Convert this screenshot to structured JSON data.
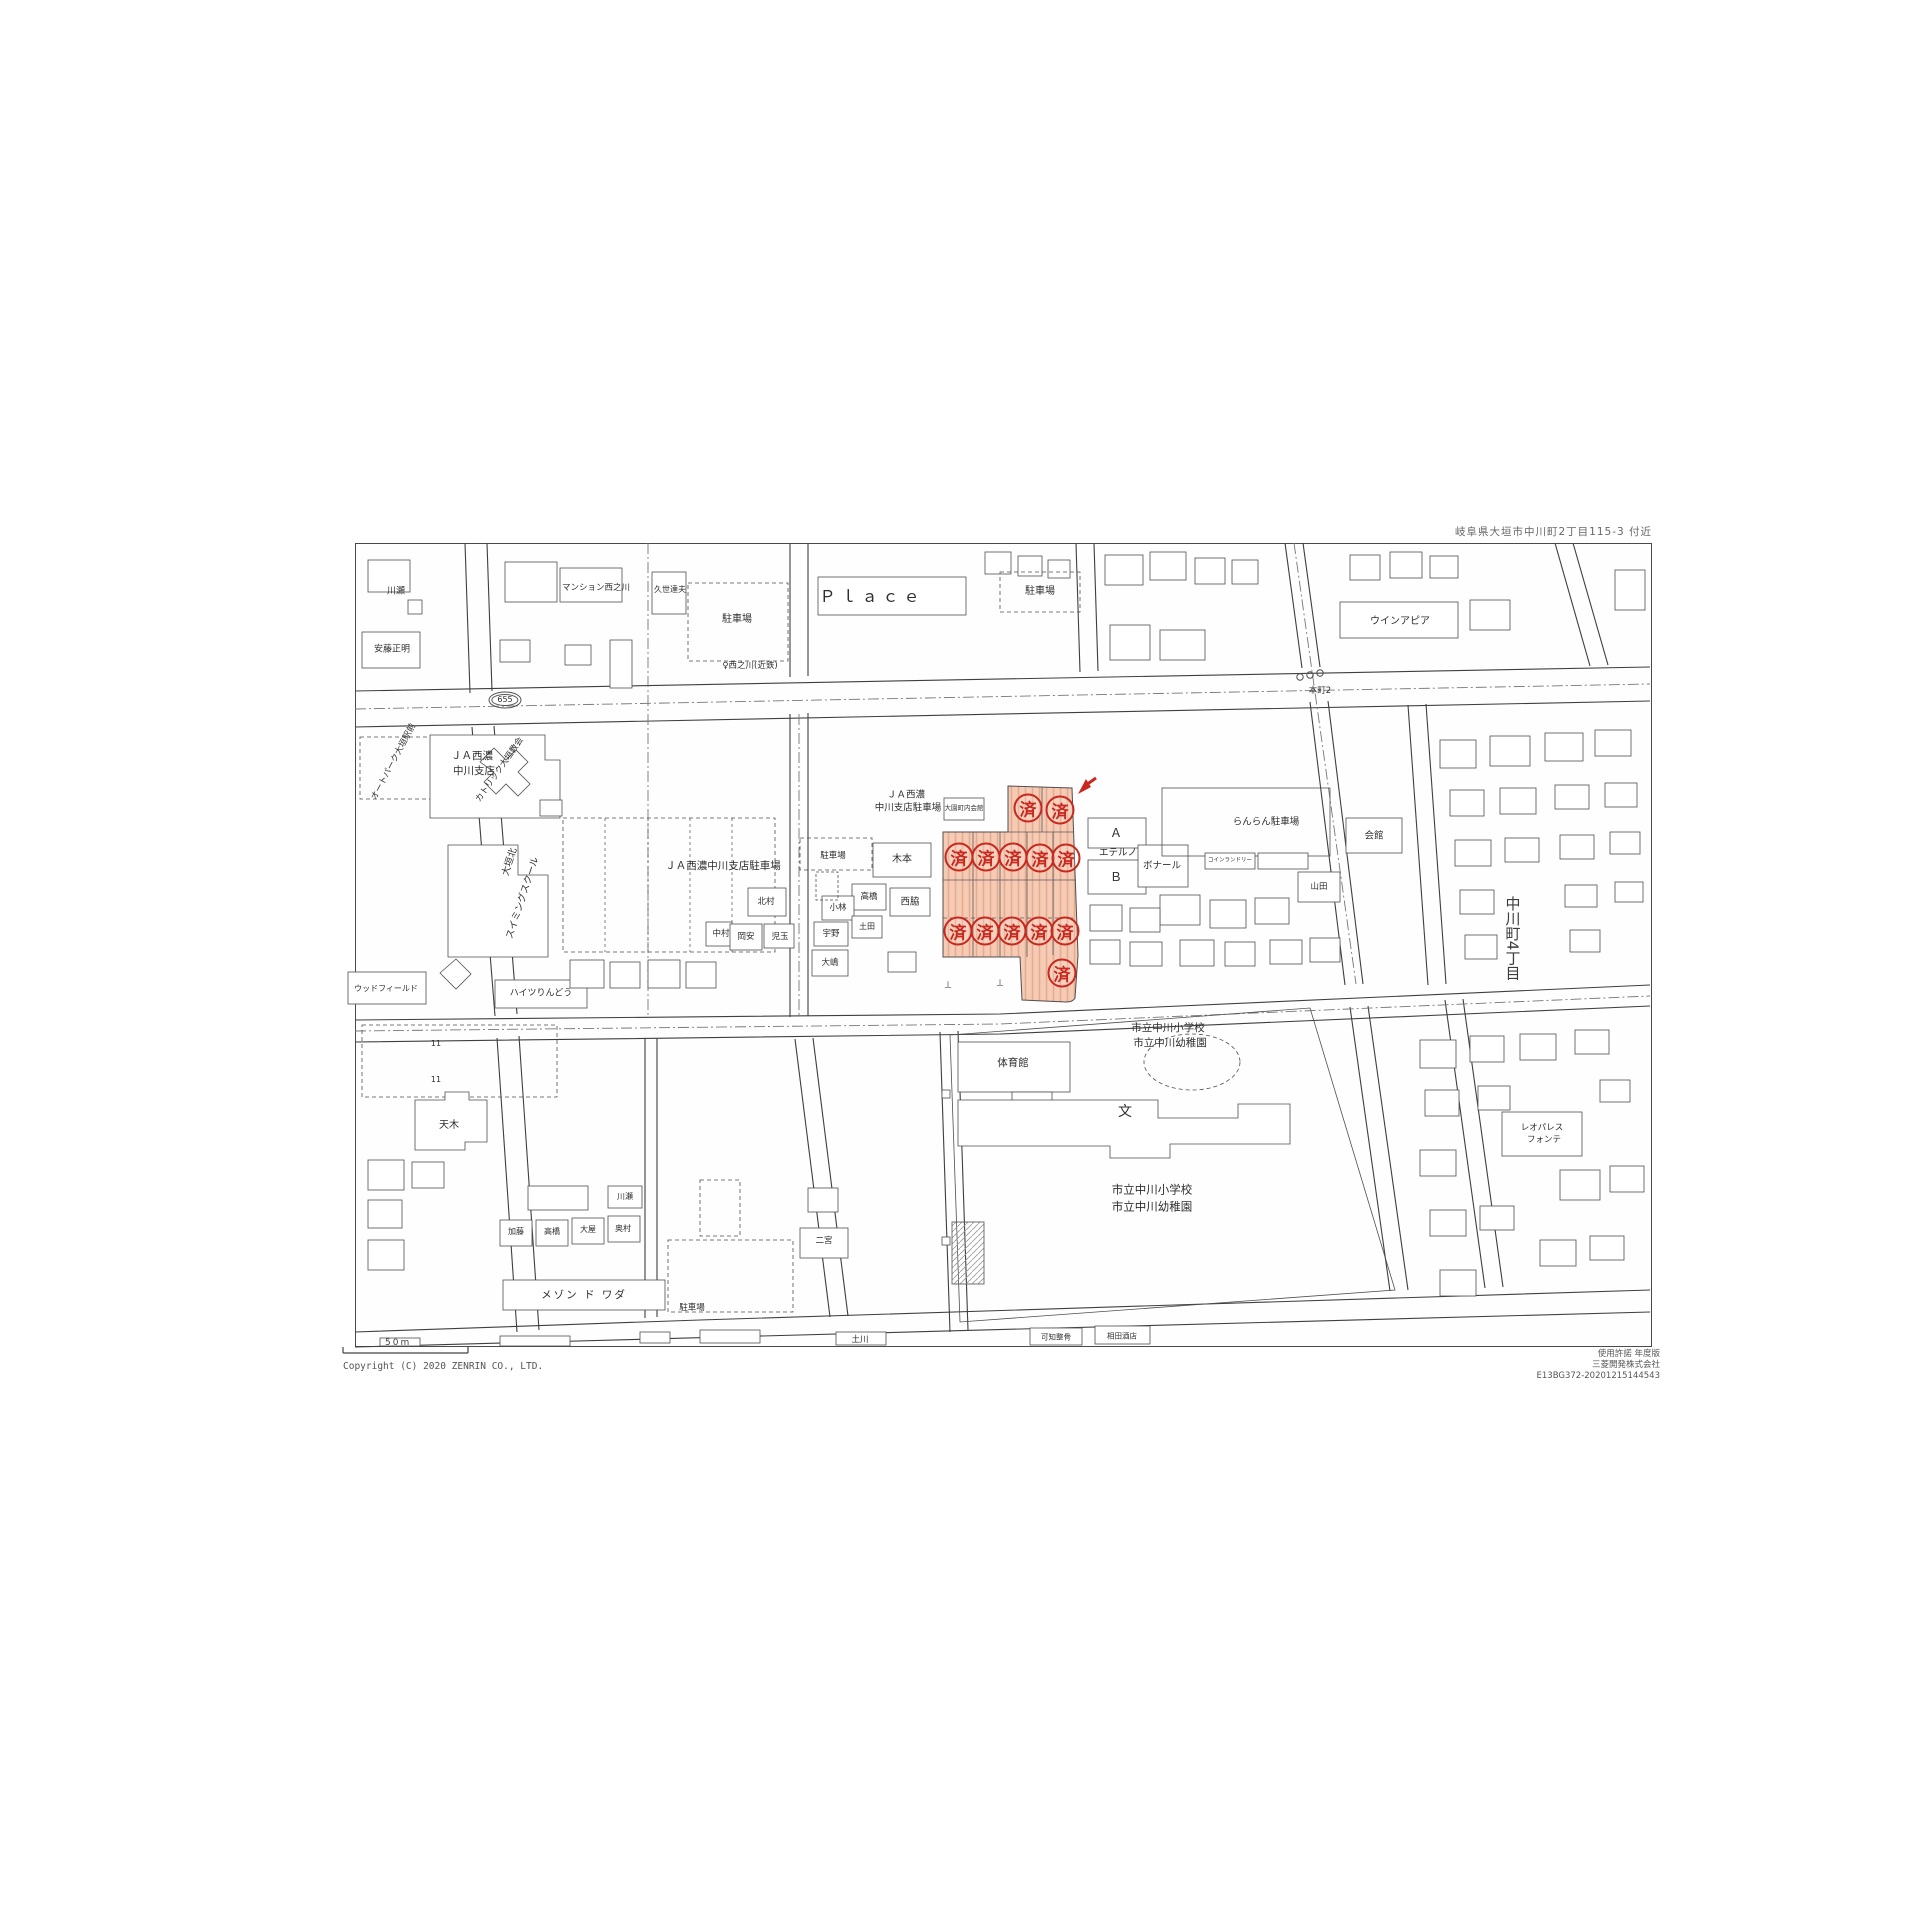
{
  "header": {
    "area_title": "岐阜県大垣市中川町2丁目115-3 付近"
  },
  "footer": {
    "copyright": "Copyright (C) 2020 ZENRIN CO., LTD.",
    "scale_label": "50m",
    "right_lines": [
      "使用許諾 年度版",
      "三菱開発株式会社",
      "E13BG372-20201215144543"
    ]
  },
  "highlight": {
    "stamp_char": "済",
    "stamp_count": 13,
    "stamp_color": "#c8281e",
    "zone_fill": "#f5c6ae",
    "zone_hatch": "#e3a183",
    "stamps": [
      [
        1028,
        808
      ],
      [
        1060,
        810
      ],
      [
        959,
        857
      ],
      [
        986,
        857
      ],
      [
        1013,
        857
      ],
      [
        1040,
        858
      ],
      [
        1066,
        858
      ],
      [
        958,
        931
      ],
      [
        985,
        931
      ],
      [
        1012,
        931
      ],
      [
        1039,
        931
      ],
      [
        1065,
        931
      ],
      [
        1062,
        973
      ]
    ]
  },
  "map": {
    "labels": [
      {
        "t": "Ｐｌａｃｅ",
        "x": 872,
        "y": 597,
        "s": 16,
        "ls": 5,
        "n": "label-place"
      },
      {
        "t": "駐車場",
        "x": 737,
        "y": 620,
        "s": 10
      },
      {
        "t": "駐車場",
        "x": 1040,
        "y": 592,
        "s": 10
      },
      {
        "t": "マンション西之川",
        "x": 596,
        "y": 588,
        "s": 8.5
      },
      {
        "t": "川瀬",
        "x": 396,
        "y": 592,
        "s": 9
      },
      {
        "t": "安藤正明",
        "x": 392,
        "y": 650,
        "s": 9
      },
      {
        "t": "久世達夫",
        "x": 670,
        "y": 590,
        "s": 8
      },
      {
        "t": "ウインアピア",
        "x": 1400,
        "y": 622,
        "s": 10
      },
      {
        "t": "♀西之川(近鉄)",
        "x": 750,
        "y": 666,
        "s": 8.5,
        "n": "bus-stop-label"
      },
      {
        "t": "655",
        "x": 505,
        "y": 700,
        "s": 8,
        "o": true,
        "n": "route-marker"
      },
      {
        "t": "本町2",
        "x": 1320,
        "y": 691,
        "s": 8.5,
        "n": "intersection-label"
      },
      {
        "t": "オートパーク大垣駅前",
        "x": 394,
        "y": 762,
        "s": 8.5,
        "r": -62
      },
      {
        "t": "ＪＡ西濃",
        "x": 472,
        "y": 756,
        "s": 10.5
      },
      {
        "t": "中川支店",
        "x": 474,
        "y": 771,
        "s": 10.5
      },
      {
        "t": "カトリック大垣教会",
        "x": 500,
        "y": 770,
        "s": 8.5,
        "r": -55
      },
      {
        "t": "大垣北",
        "x": 510,
        "y": 862,
        "s": 9.5,
        "r": -72
      },
      {
        "t": "スイミングスクール",
        "x": 523,
        "y": 898,
        "s": 9.5,
        "r": -72
      },
      {
        "t": "ＪＡ西濃中川支店駐車場",
        "x": 723,
        "y": 866,
        "s": 10.5
      },
      {
        "t": "ＪＡ西濃",
        "x": 906,
        "y": 795,
        "s": 9.5
      },
      {
        "t": "中川支店駐車場",
        "x": 908,
        "y": 808,
        "s": 9.5
      },
      {
        "t": "駐車場",
        "x": 833,
        "y": 856,
        "s": 8.5
      },
      {
        "t": "木本",
        "x": 902,
        "y": 860,
        "s": 10
      },
      {
        "t": "北村",
        "x": 766,
        "y": 902,
        "s": 8.5
      },
      {
        "t": "高橋",
        "x": 869,
        "y": 897,
        "s": 8.5
      },
      {
        "t": "小林",
        "x": 838,
        "y": 908,
        "s": 8.5
      },
      {
        "t": "西脇",
        "x": 910,
        "y": 902,
        "s": 9.5
      },
      {
        "t": "中村",
        "x": 721,
        "y": 934,
        "s": 8.5
      },
      {
        "t": "岡安",
        "x": 746,
        "y": 937,
        "s": 8.5
      },
      {
        "t": "児玉",
        "x": 780,
        "y": 937,
        "s": 8.5
      },
      {
        "t": "宇野",
        "x": 831,
        "y": 934,
        "s": 8.5
      },
      {
        "t": "土田",
        "x": 867,
        "y": 927,
        "s": 8
      },
      {
        "t": "大嶋",
        "x": 830,
        "y": 963,
        "s": 8.5
      },
      {
        "t": "大園町内会館",
        "x": 964,
        "y": 808,
        "s": 6.5
      },
      {
        "t": "Ａ",
        "x": 1116,
        "y": 833,
        "s": 12
      },
      {
        "t": "エテルノ",
        "x": 1118,
        "y": 853,
        "s": 9.5
      },
      {
        "t": "Ｂ",
        "x": 1116,
        "y": 877,
        "s": 12
      },
      {
        "t": "ボナール",
        "x": 1162,
        "y": 866,
        "s": 9.5
      },
      {
        "t": "らんらん駐車場",
        "x": 1266,
        "y": 822,
        "s": 9.5
      },
      {
        "t": "コインランドリー",
        "x": 1230,
        "y": 861,
        "s": 5.5
      },
      {
        "t": "山田",
        "x": 1319,
        "y": 887,
        "s": 8.5
      },
      {
        "t": "会館",
        "x": 1374,
        "y": 836,
        "s": 9.5
      },
      {
        "t": "中川町4丁目",
        "x": 1512,
        "y": 938,
        "s": 15,
        "v": true,
        "c": "#3c3c3c",
        "n": "district-label"
      },
      {
        "t": "ウッドフィールド",
        "x": 386,
        "y": 989,
        "s": 8
      },
      {
        "t": "ハイツりんどう",
        "x": 541,
        "y": 994,
        "s": 9
      },
      {
        "t": "天木",
        "x": 449,
        "y": 1126,
        "s": 10
      },
      {
        "t": "体育館",
        "x": 1013,
        "y": 1063,
        "s": 10.5
      },
      {
        "t": "市立中川小学校",
        "x": 1168,
        "y": 1028,
        "s": 10.5
      },
      {
        "t": "市立中川幼稚園",
        "x": 1170,
        "y": 1043,
        "s": 10.5
      },
      {
        "t": "文",
        "x": 1125,
        "y": 1112,
        "s": 14,
        "n": "school-symbol"
      },
      {
        "t": "市立中川小学校",
        "x": 1152,
        "y": 1190,
        "s": 11.5
      },
      {
        "t": "市立中川幼稚園",
        "x": 1152,
        "y": 1207,
        "s": 11.5
      },
      {
        "t": "メゾン ド ワダ",
        "x": 584,
        "y": 1295,
        "s": 10.5,
        "ls": 2
      },
      {
        "t": "駐車場",
        "x": 692,
        "y": 1308,
        "s": 8.5
      },
      {
        "t": "加藤",
        "x": 516,
        "y": 1232,
        "s": 8
      },
      {
        "t": "高橋",
        "x": 552,
        "y": 1232,
        "s": 8
      },
      {
        "t": "大屋",
        "x": 588,
        "y": 1230,
        "s": 8
      },
      {
        "t": "奥村",
        "x": 623,
        "y": 1229,
        "s": 8
      },
      {
        "t": "川瀬",
        "x": 625,
        "y": 1197,
        "s": 8
      },
      {
        "t": "二宮",
        "x": 824,
        "y": 1241,
        "s": 8.5
      },
      {
        "t": "土川",
        "x": 860,
        "y": 1340,
        "s": 8.5
      },
      {
        "t": "レオパレス",
        "x": 1542,
        "y": 1128,
        "s": 8.5
      },
      {
        "t": "フォンテ",
        "x": 1544,
        "y": 1140,
        "s": 8.5
      },
      {
        "t": "可知整骨",
        "x": 1056,
        "y": 1337,
        "s": 7.5
      },
      {
        "t": "相田酒店",
        "x": 1122,
        "y": 1336,
        "s": 7.5
      },
      {
        "t": "⊥",
        "x": 948,
        "y": 986,
        "s": 9
      },
      {
        "t": "⊥",
        "x": 1000,
        "y": 984,
        "s": 9
      },
      {
        "t": "11",
        "x": 436,
        "y": 1044,
        "s": 8
      },
      {
        "t": "11",
        "x": 436,
        "y": 1080,
        "s": 8
      }
    ]
  }
}
